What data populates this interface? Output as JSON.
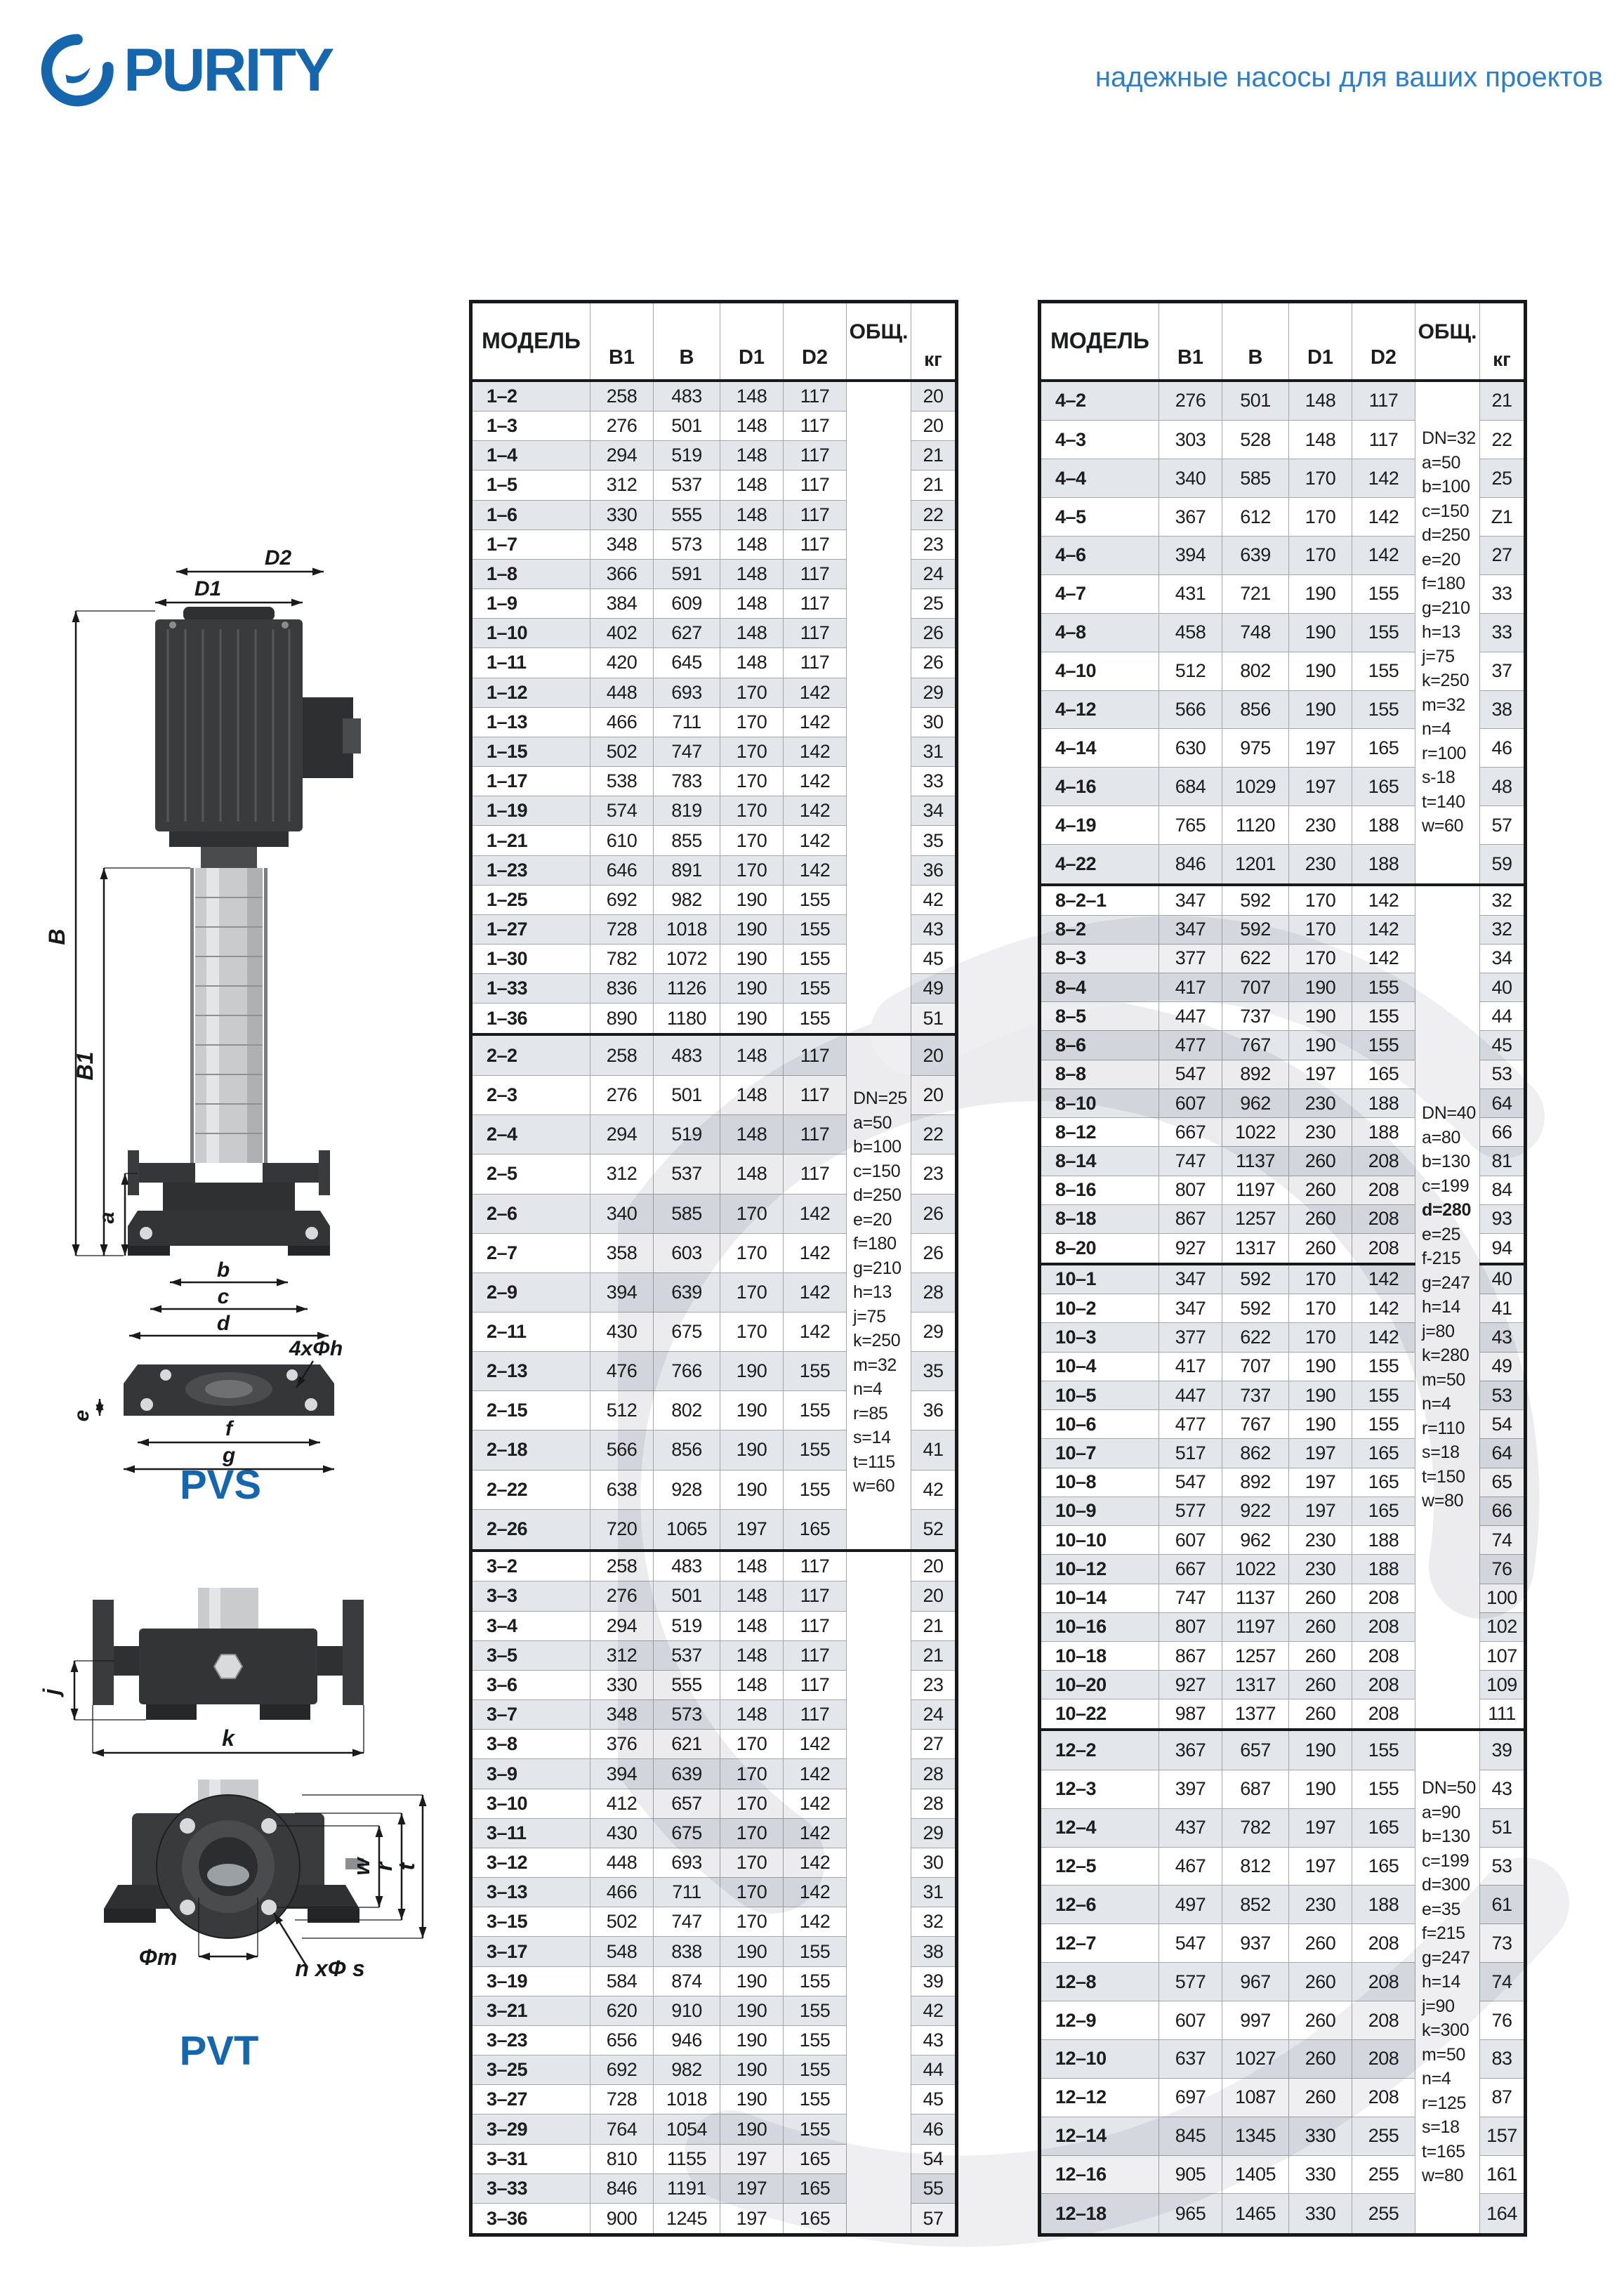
{
  "brand": {
    "name": "PURITY",
    "tagline": "надежные насосы для ваших проектов"
  },
  "colors": {
    "brand_blue": "#1566ad",
    "tagline_blue": "#2e7ec5",
    "row_shade": "#e3e7eb",
    "table_border_dark": "#18191a",
    "table_border_gray": "#a2a7ab",
    "watermark_gray": "#ececee"
  },
  "diagrams": {
    "pvs": {
      "label": "PVS",
      "d2": "D2",
      "d1": "D1",
      "B": "B",
      "B1": "B1",
      "a": "a",
      "b": "b",
      "c": "c",
      "d": "d",
      "e": "e",
      "f": "f",
      "g": "g",
      "holes": "4xΦh"
    },
    "flange": {
      "j": "j",
      "k": "k"
    },
    "pvt": {
      "label": "PVT",
      "w": "w",
      "r": "r",
      "t": "t",
      "m": "Φm",
      "holes": "n xΦ s"
    }
  },
  "tables": {
    "columns": [
      "МОДЕЛЬ",
      "B1",
      "B",
      "D1",
      "D2",
      "ОБЩ.",
      "кг"
    ],
    "left": {
      "groups": [
        {
          "notes": [],
          "rows": [
            [
              "1–2",
              258,
              483,
              148,
              117,
              20
            ],
            [
              "1–3",
              276,
              501,
              148,
              117,
              20
            ],
            [
              "1–4",
              294,
              519,
              148,
              117,
              21
            ],
            [
              "1–5",
              312,
              537,
              148,
              117,
              21
            ],
            [
              "1–6",
              330,
              555,
              148,
              117,
              22
            ],
            [
              "1–7",
              348,
              573,
              148,
              117,
              23
            ],
            [
              "1–8",
              366,
              591,
              148,
              117,
              24
            ],
            [
              "1–9",
              384,
              609,
              148,
              117,
              25
            ],
            [
              "1–10",
              402,
              627,
              148,
              117,
              26
            ],
            [
              "1–11",
              420,
              645,
              148,
              117,
              26
            ],
            [
              "1–12",
              448,
              693,
              170,
              142,
              29
            ],
            [
              "1–13",
              466,
              711,
              170,
              142,
              30
            ],
            [
              "1–15",
              502,
              747,
              170,
              142,
              31
            ],
            [
              "1–17",
              538,
              783,
              170,
              142,
              33
            ],
            [
              "1–19",
              574,
              819,
              170,
              142,
              34
            ],
            [
              "1–21",
              610,
              855,
              170,
              142,
              35
            ],
            [
              "1–23",
              646,
              891,
              170,
              142,
              36
            ],
            [
              "1–25",
              692,
              982,
              190,
              155,
              42
            ],
            [
              "1–27",
              728,
              1018,
              190,
              155,
              43
            ],
            [
              "1–30",
              782,
              1072,
              190,
              155,
              45
            ],
            [
              "1–33",
              836,
              1126,
              190,
              155,
              49
            ],
            [
              "1–36",
              890,
              1180,
              190,
              155,
              51
            ]
          ]
        },
        {
          "notes": [
            "DN=25",
            "a=50",
            "b=100",
            "c=150",
            "d=250",
            "e=20",
            "f=180",
            "g=210",
            "h=13",
            "j=75",
            "k=250",
            "m=32",
            "n=4",
            "r=85",
            "s=14",
            "t=115",
            "w=60"
          ],
          "rows": [
            [
              "2–2",
              258,
              483,
              148,
              117,
              20
            ],
            [
              "2–3",
              276,
              501,
              148,
              117,
              20
            ],
            [
              "2–4",
              294,
              519,
              148,
              117,
              22
            ],
            [
              "2–5",
              312,
              537,
              148,
              117,
              23
            ],
            [
              "2–6",
              340,
              585,
              170,
              142,
              26
            ],
            [
              "2–7",
              358,
              603,
              170,
              142,
              26
            ],
            [
              "2–9",
              394,
              639,
              170,
              142,
              28
            ],
            [
              "2–11",
              430,
              675,
              170,
              142,
              29
            ],
            [
              "2–13",
              476,
              766,
              190,
              155,
              35
            ],
            [
              "2–15",
              512,
              802,
              190,
              155,
              36
            ],
            [
              "2–18",
              566,
              856,
              190,
              155,
              41
            ],
            [
              "2–22",
              638,
              928,
              190,
              155,
              42
            ],
            [
              "2–26",
              720,
              1065,
              197,
              165,
              52
            ]
          ]
        },
        {
          "notes": [],
          "rows": [
            [
              "3–2",
              258,
              483,
              148,
              117,
              20
            ],
            [
              "3–3",
              276,
              501,
              148,
              117,
              20
            ],
            [
              "3–4",
              294,
              519,
              148,
              117,
              21
            ],
            [
              "3–5",
              312,
              537,
              148,
              117,
              21
            ],
            [
              "3–6",
              330,
              555,
              148,
              117,
              23
            ],
            [
              "3–7",
              348,
              573,
              148,
              117,
              24
            ],
            [
              "3–8",
              376,
              621,
              170,
              142,
              27
            ],
            [
              "3–9",
              394,
              639,
              170,
              142,
              28
            ],
            [
              "3–10",
              412,
              657,
              170,
              142,
              28
            ],
            [
              "3–11",
              430,
              675,
              170,
              142,
              29
            ],
            [
              "3–12",
              448,
              693,
              170,
              142,
              30
            ],
            [
              "3–13",
              466,
              711,
              170,
              142,
              31
            ],
            [
              "3–15",
              502,
              747,
              170,
              142,
              32
            ],
            [
              "3–17",
              548,
              838,
              190,
              155,
              38
            ],
            [
              "3–19",
              584,
              874,
              190,
              155,
              39
            ],
            [
              "3–21",
              620,
              910,
              190,
              155,
              42
            ],
            [
              "3–23",
              656,
              946,
              190,
              155,
              43
            ],
            [
              "3–25",
              692,
              982,
              190,
              155,
              44
            ],
            [
              "3–27",
              728,
              1018,
              190,
              155,
              45
            ],
            [
              "3–29",
              764,
              1054,
              190,
              155,
              46
            ],
            [
              "3–31",
              810,
              1155,
              197,
              165,
              54
            ],
            [
              "3–33",
              846,
              1191,
              197,
              165,
              55
            ],
            [
              "3–36",
              900,
              1245,
              197,
              165,
              57
            ]
          ]
        }
      ]
    },
    "right": {
      "groups": [
        {
          "notes": [
            "DN=32",
            "a=50",
            "b=100",
            "c=150",
            "d=250",
            "e=20",
            "f=180",
            "g=210",
            "h=13",
            "j=75",
            "k=250",
            "m=32",
            "n=4",
            "r=100",
            "s-18",
            "t=140",
            "w=60"
          ],
          "rows": [
            [
              "4–2",
              276,
              501,
              148,
              117,
              21
            ],
            [
              "4–3",
              303,
              528,
              148,
              117,
              22
            ],
            [
              "4–4",
              340,
              585,
              170,
              142,
              25
            ],
            [
              "4–5",
              367,
              612,
              170,
              142,
              "Z1"
            ],
            [
              "4–6",
              394,
              639,
              170,
              142,
              27
            ],
            [
              "4–7",
              431,
              721,
              190,
              155,
              33
            ],
            [
              "4–8",
              458,
              748,
              190,
              155,
              33
            ],
            [
              "4–10",
              512,
              802,
              190,
              155,
              37
            ],
            [
              "4–12",
              566,
              856,
              190,
              155,
              38
            ],
            [
              "4–14",
              630,
              975,
              197,
              165,
              46
            ],
            [
              "4–16",
              684,
              1029,
              197,
              165,
              48
            ],
            [
              "4–19",
              765,
              1120,
              230,
              188,
              57
            ],
            [
              "4–22",
              846,
              1201,
              230,
              188,
              59
            ]
          ]
        },
        {
          "notes": [
            "DN=40",
            "a=80",
            "b=130",
            "c=199",
            "d=280",
            "e=25",
            "f-215",
            "g=247",
            "h=14",
            "j=80",
            "k=280",
            "m=50",
            "n=4",
            "r=110",
            "s=18",
            "t=150",
            "w=80"
          ],
          "bold": [
            "d=280"
          ],
          "subgroup_break": 13,
          "rows": [
            [
              "8–2–1",
              347,
              592,
              170,
              142,
              32
            ],
            [
              "8–2",
              347,
              592,
              170,
              142,
              32
            ],
            [
              "8–3",
              377,
              622,
              170,
              142,
              34
            ],
            [
              "8–4",
              417,
              707,
              190,
              155,
              40
            ],
            [
              "8–5",
              447,
              737,
              190,
              155,
              44
            ],
            [
              "8–6",
              477,
              767,
              190,
              155,
              45
            ],
            [
              "8–8",
              547,
              892,
              197,
              165,
              53
            ],
            [
              "8–10",
              607,
              962,
              230,
              188,
              64
            ],
            [
              "8–12",
              667,
              1022,
              230,
              188,
              66
            ],
            [
              "8–14",
              747,
              1137,
              260,
              208,
              81
            ],
            [
              "8–16",
              807,
              1197,
              260,
              208,
              84
            ],
            [
              "8–18",
              867,
              1257,
              260,
              208,
              93
            ],
            [
              "8–20",
              927,
              1317,
              260,
              208,
              94
            ],
            [
              "10–1",
              347,
              592,
              170,
              142,
              40
            ],
            [
              "10–2",
              347,
              592,
              170,
              142,
              41
            ],
            [
              "10–3",
              377,
              622,
              170,
              142,
              43
            ],
            [
              "10–4",
              417,
              707,
              190,
              155,
              49
            ],
            [
              "10–5",
              447,
              737,
              190,
              155,
              53
            ],
            [
              "10–6",
              477,
              767,
              190,
              155,
              54
            ],
            [
              "10–7",
              517,
              862,
              197,
              165,
              64
            ],
            [
              "10–8",
              547,
              892,
              197,
              165,
              65
            ],
            [
              "10–9",
              577,
              922,
              197,
              165,
              66
            ],
            [
              "10–10",
              607,
              962,
              230,
              188,
              74
            ],
            [
              "10–12",
              667,
              1022,
              230,
              188,
              76
            ],
            [
              "10–14",
              747,
              1137,
              260,
              208,
              100
            ],
            [
              "10–16",
              807,
              1197,
              260,
              208,
              102
            ],
            [
              "10–18",
              867,
              1257,
              260,
              208,
              107
            ],
            [
              "10–20",
              927,
              1317,
              260,
              208,
              109
            ],
            [
              "10–22",
              987,
              1377,
              260,
              208,
              111
            ]
          ]
        },
        {
          "notes": [
            "DN=50",
            "a=90",
            "b=130",
            "c=199",
            "d=300",
            "e=35",
            "f=215",
            "g=247",
            "h=14",
            "j=90",
            "k=300",
            "m=50",
            "n=4",
            "r=125",
            "s=18",
            "t=165",
            "w=80"
          ],
          "rows": [
            [
              "12–2",
              367,
              657,
              190,
              155,
              39
            ],
            [
              "12–3",
              397,
              687,
              190,
              155,
              43
            ],
            [
              "12–4",
              437,
              782,
              197,
              165,
              51
            ],
            [
              "12–5",
              467,
              812,
              197,
              165,
              53
            ],
            [
              "12–6",
              497,
              852,
              230,
              188,
              61
            ],
            [
              "12–7",
              547,
              937,
              260,
              208,
              73
            ],
            [
              "12–8",
              577,
              967,
              260,
              208,
              74
            ],
            [
              "12–9",
              607,
              997,
              260,
              208,
              76
            ],
            [
              "12–10",
              637,
              1027,
              260,
              208,
              83
            ],
            [
              "12–12",
              697,
              1087,
              260,
              208,
              87
            ],
            [
              "12–14",
              845,
              1345,
              330,
              255,
              157
            ],
            [
              "12–16",
              905,
              1405,
              330,
              255,
              161
            ],
            [
              "12–18",
              965,
              1465,
              330,
              255,
              164
            ]
          ]
        }
      ]
    }
  }
}
